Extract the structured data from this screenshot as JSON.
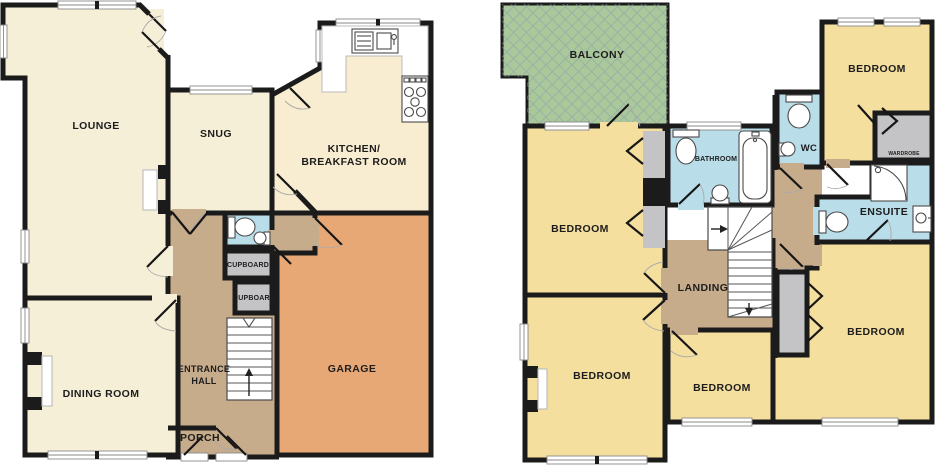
{
  "palette": {
    "wall": "#1b1b1b",
    "cream": "#f6efd7",
    "kitchen": "#f8edd0",
    "yellow": "#f5df9f",
    "tan": "#c7ac8b",
    "orange": "#e8a876",
    "blue": "#b9dde9",
    "gray": "#c4c4c6",
    "green": "#abc89b",
    "lattice": "#86a0ab",
    "white": "#ffffff"
  },
  "ground": {
    "lounge": "LOUNGE",
    "snug": "SNUG",
    "kitchen1": "KITCHEN/",
    "kitchen2": "BREAKFAST ROOM",
    "dining": "DINING ROOM",
    "hall1": "ENTRANCE",
    "hall2": "HALL",
    "porch": "PORCH",
    "garage": "GARAGE",
    "cupboard_top": "CUPBOARD",
    "cupboard_bottom": "CUPBOARD"
  },
  "first": {
    "balcony": "BALCONY",
    "bedroom_top_left": "BEDROOM",
    "bedroom_top_right": "BEDROOM",
    "bedroom_bottom_left": "BEDROOM",
    "bedroom_bottom_middle": "BEDROOM",
    "bedroom_bottom_right": "BEDROOM",
    "bathroom": "BATHROOM",
    "wc": "WC",
    "ensuite": "ENSUITE",
    "wardrobe": "WARDROBE",
    "landing": "LANDING"
  }
}
